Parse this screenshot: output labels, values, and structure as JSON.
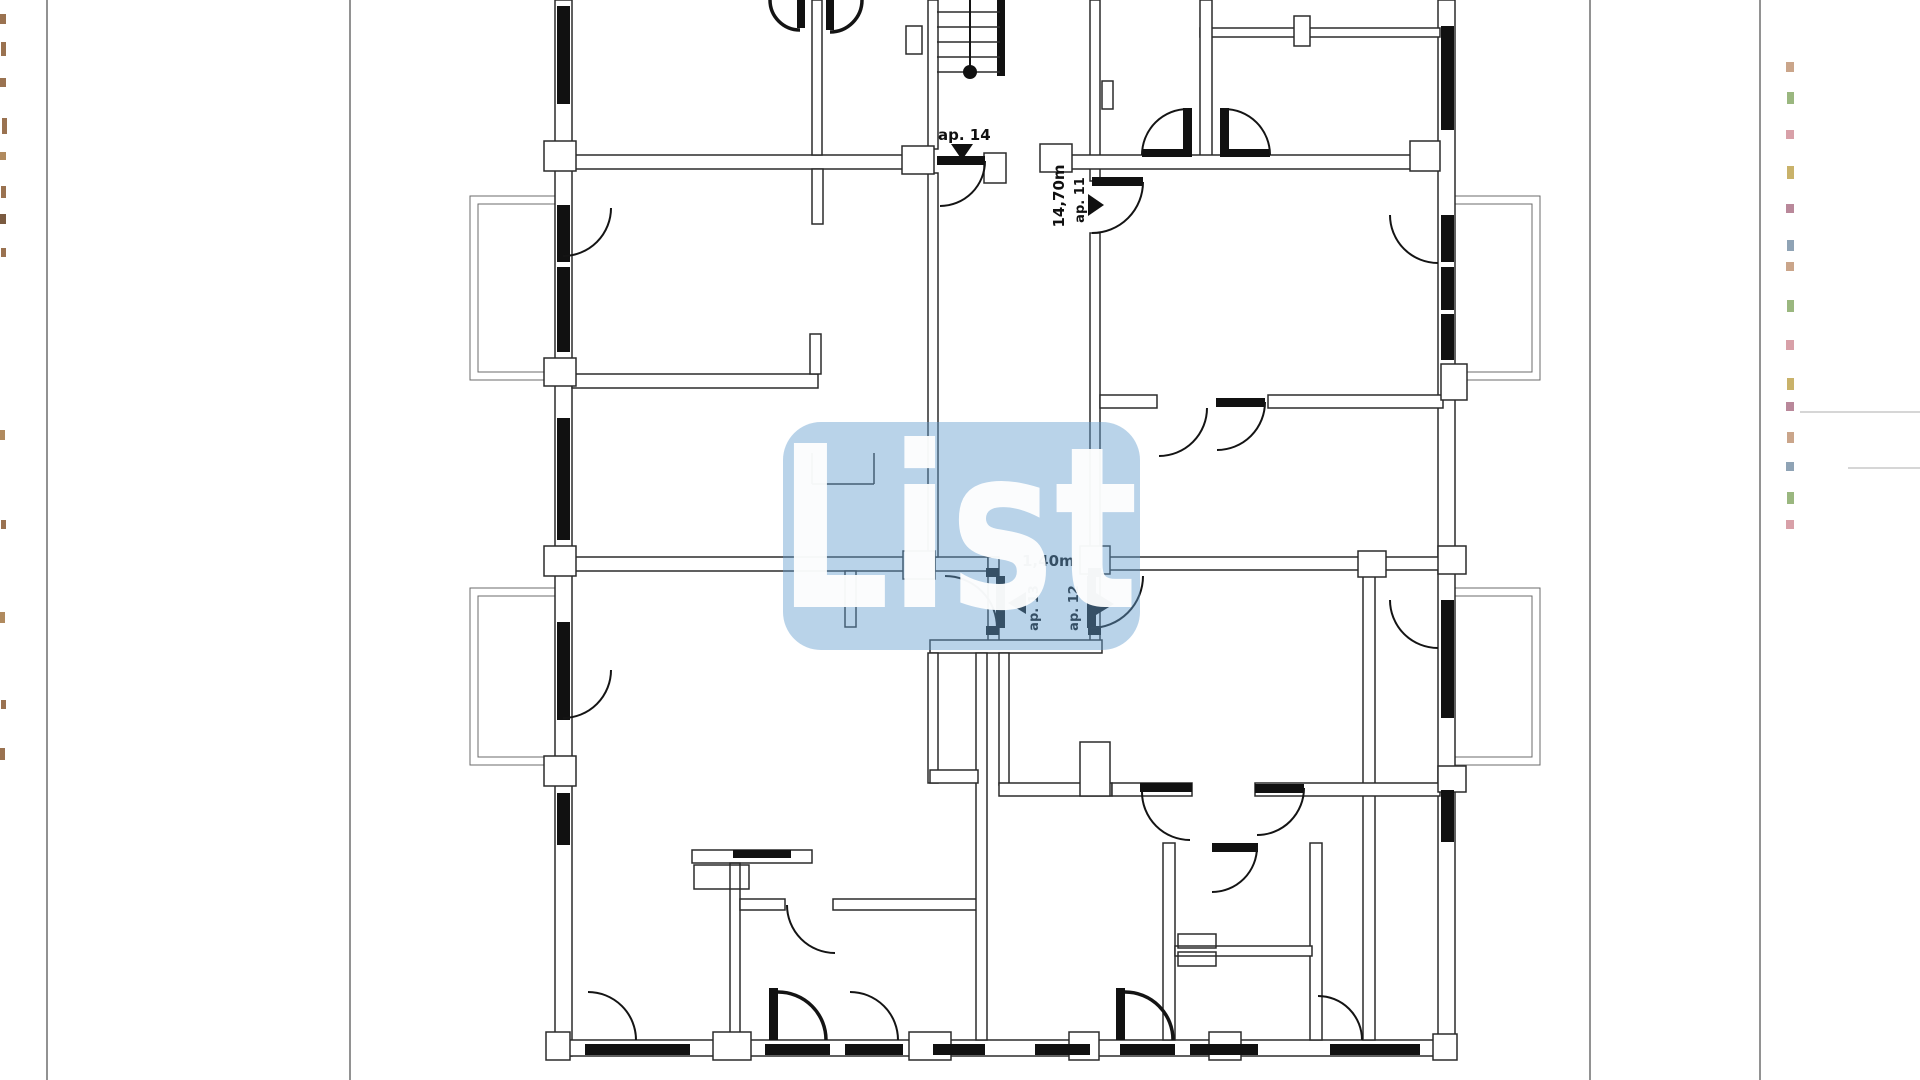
{
  "document": {
    "type": "scanned floor plan",
    "background": "#ffffff",
    "line_color": "#2b2b2b",
    "window_color": "#111111"
  },
  "watermark": {
    "text": "List",
    "box_color": "#649ecf",
    "text_color": "#ffffff"
  },
  "labels": {
    "ap14": "ap. 14",
    "ap11": "ap. 11",
    "ap11_dimension": "14,70m",
    "ap13": "ap. 13",
    "ap12": "ap. 12",
    "hall_dimension": "1,40m"
  },
  "artifacts": {
    "left_strip_color": "#9a7250",
    "right_strip_colors": [
      "#caa58a",
      "#9ab77f",
      "#d8a0a8",
      "#c9b26a",
      "#b9889a",
      "#8fa3b5"
    ]
  }
}
